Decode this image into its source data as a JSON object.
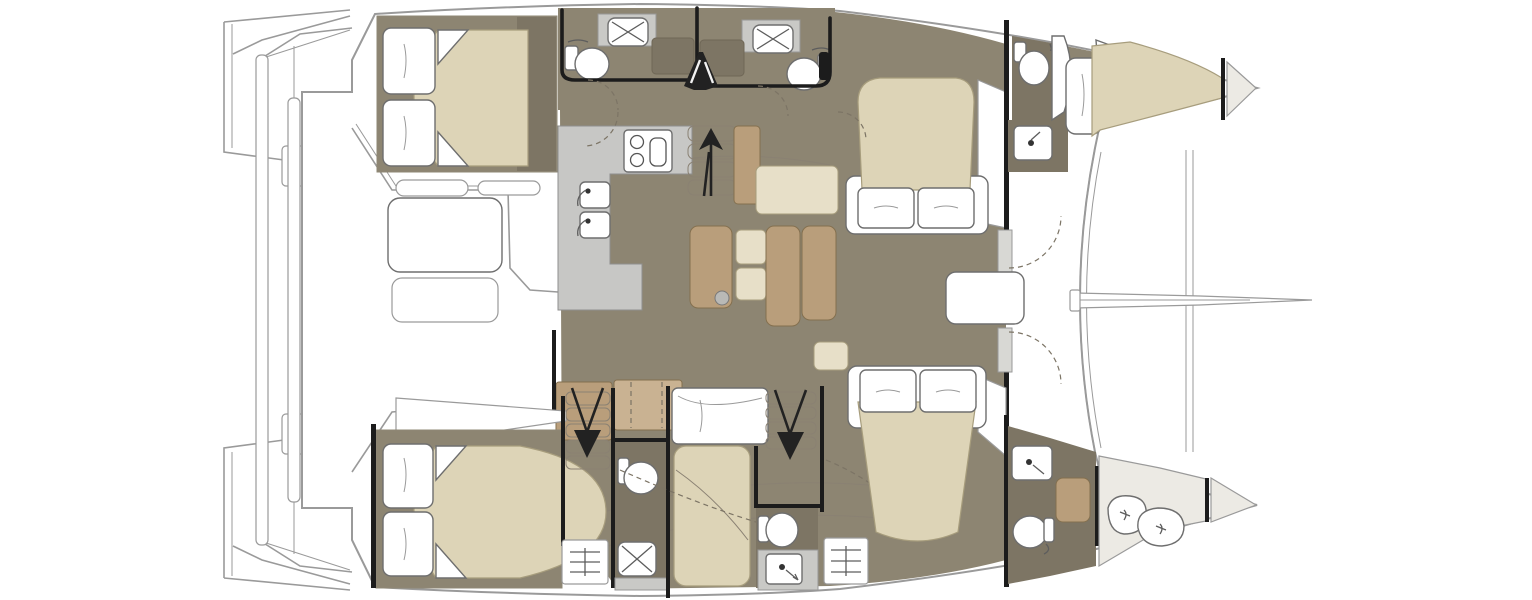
{
  "title": "Catamaran interior layout floor plan (top view)",
  "palette": {
    "bg": "#ffffff",
    "floor": "#8d8572",
    "floorDark": "#7d7564",
    "beige": "#ddd4b7",
    "beigeLight": "#e7dfc8",
    "tan": "#b99e7b",
    "tanLight": "#c9b292",
    "counter": "#c7c7c5",
    "tray": "#c9c9c6",
    "deckShade": "#eceae4",
    "line": "#9a9a9a",
    "wall": "#1c1c1c",
    "arrow": "#222222"
  },
  "orientation": {
    "bow": "right",
    "stern": "left"
  },
  "regions": [
    {
      "name": "aft-cockpit"
    },
    {
      "name": "port-hull-aft-cabin"
    },
    {
      "name": "port-hull-heads"
    },
    {
      "name": "port-hull-mid-cabin"
    },
    {
      "name": "port-hull-forward-cabin"
    },
    {
      "name": "salon-galley"
    },
    {
      "name": "salon-dinette"
    },
    {
      "name": "forward-cockpit"
    },
    {
      "name": "trampoline"
    },
    {
      "name": "starboard-hull-aft-cabin"
    },
    {
      "name": "starboard-hull-heads"
    },
    {
      "name": "starboard-hull-berth"
    },
    {
      "name": "starboard-hull-forward-cabin"
    },
    {
      "name": "sail-locker"
    }
  ],
  "fixtures": [
    "double-bed-icon",
    "pillow-icon",
    "shower-icon",
    "toilet-icon",
    "sink-icon",
    "stove-icon",
    "galley-counter",
    "stairs-up-arrow-icon",
    "stairs-down-arrow-icon",
    "cockpit-table",
    "cockpit-bench",
    "sofa",
    "salon-table",
    "sail-bags-icon",
    "engine-hatch-icon",
    "bowsprit",
    "crossbeam",
    "swim-platform",
    "davit-bars",
    "companionway-icon",
    "door-swing-arc"
  ]
}
